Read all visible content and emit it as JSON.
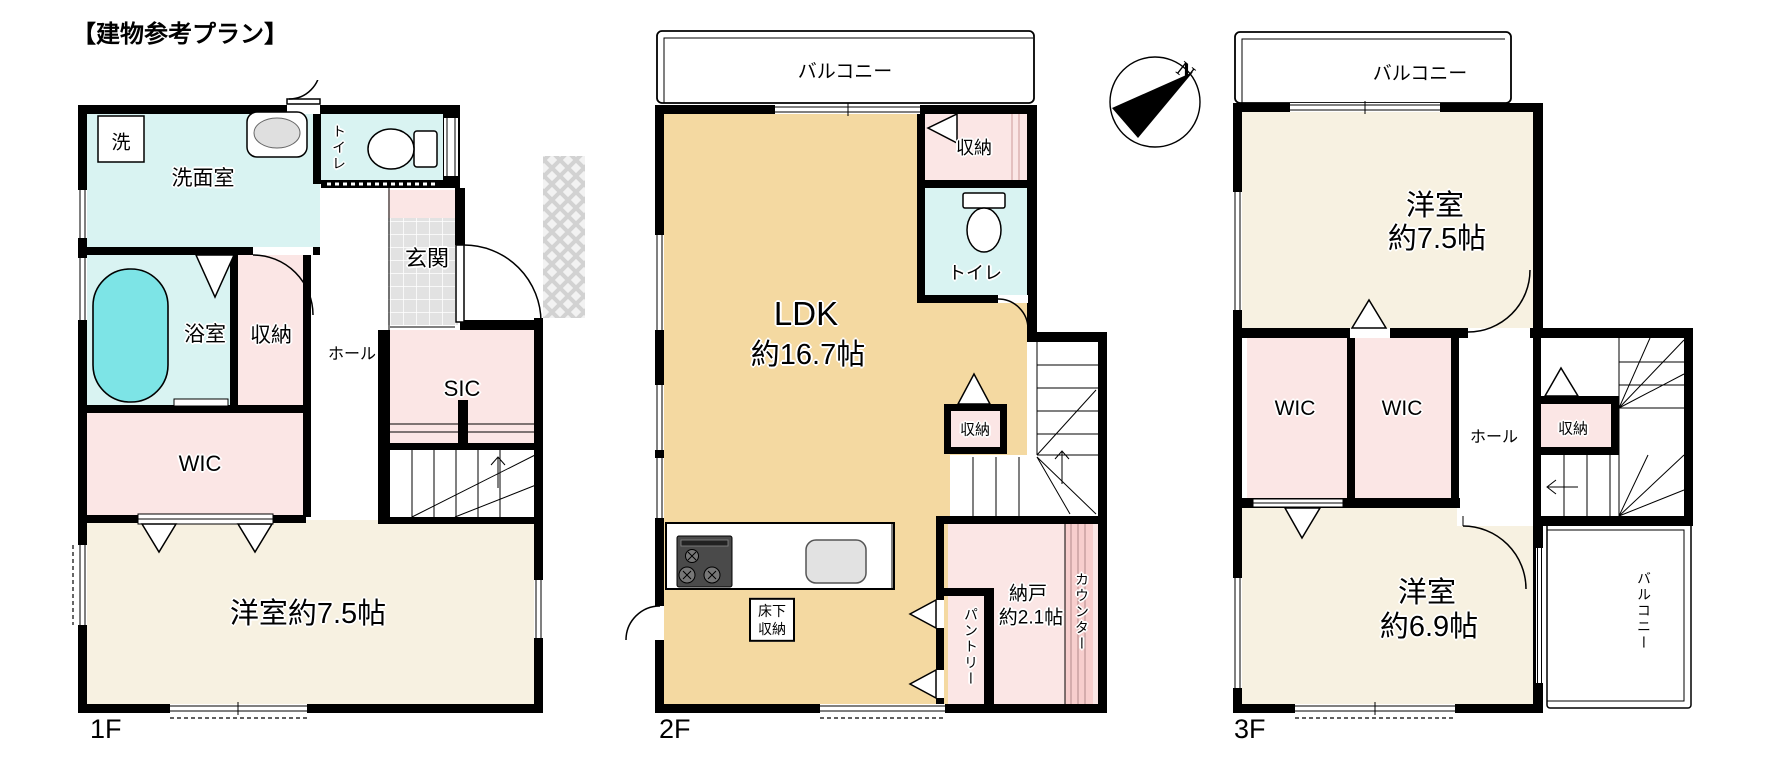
{
  "title": "【建物参考プラン】",
  "colors": {
    "wall": "#000000",
    "cream": "#f7f1e1",
    "tan": "#f4d9a1",
    "pink": "#fbe6e5",
    "cyan": "#d9f3f2",
    "tub": "#7de4e6",
    "tile": "#e2e2e2",
    "counter_stripe": "#f7cecd",
    "stove": "#4a4a4a",
    "sink": "#e2e2e2"
  },
  "compass": {
    "north_label": "N"
  },
  "floor1": {
    "label": "1F",
    "rooms": {
      "washer": "洗",
      "senmen": "洗面室",
      "toilet": "トイレ",
      "bath": "浴室",
      "storage": "収納",
      "hall": "ホール",
      "genkan": "玄関",
      "sic": "SIC",
      "wic": "WIC",
      "bedroom": "洋室約7.5帖"
    }
  },
  "floor2": {
    "label": "2F",
    "balcony": "バルコニー",
    "rooms": {
      "ldk_line1": "LDK",
      "ldk_line2": "約16.7帖",
      "storage_top": "収納",
      "toilet": "トイレ",
      "storage_mid": "収納",
      "underfloor_line1": "床下",
      "underfloor_line2": "収納",
      "nando_line1": "納戸",
      "nando_line2": "約2.1帖",
      "pantry": "パントリー",
      "counter": "カウンター"
    }
  },
  "floor3": {
    "label": "3F",
    "balcony_top": "バルコニー",
    "balcony_side": "バルコニー",
    "rooms": {
      "bedroom75_line1": "洋室",
      "bedroom75_line2": "約7.5帖",
      "wic_left": "WIC",
      "wic_right": "WIC",
      "hall": "ホール",
      "storage": "収納",
      "bedroom69_line1": "洋室",
      "bedroom69_line2": "約6.9帖"
    }
  }
}
